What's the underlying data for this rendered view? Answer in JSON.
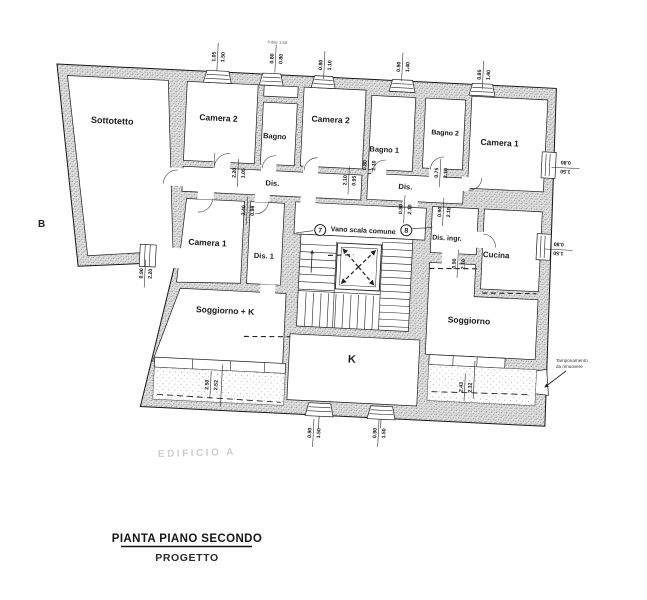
{
  "title": {
    "main": "PIANTA PIANO SECONDO",
    "sub": "PROGETTO"
  },
  "plan": {
    "section_label": "B",
    "watermark": "EDIFICIO A",
    "window_note": "h dav 1.50",
    "stair": {
      "label": "Vano scala comune",
      "unit_left": "7",
      "unit_right": "8"
    },
    "annotation": {
      "line1": "Tamponamento",
      "line2": "da rimuovere"
    },
    "rooms": [
      {
        "id": "sottotetto",
        "label": "Sottotetto",
        "x": 58,
        "y": 57,
        "fs": 9
      },
      {
        "id": "camera2-left",
        "label": "Camera 2",
        "x": 164,
        "y": 49,
        "fs": 8.5
      },
      {
        "id": "bagno",
        "label": "Bagno",
        "x": 221,
        "y": 64,
        "fs": 7.5
      },
      {
        "id": "camera2-right",
        "label": "Camera 2",
        "x": 276,
        "y": 45,
        "fs": 8.5
      },
      {
        "id": "bagno-1",
        "label": "Bagno 1",
        "x": 331,
        "y": 72,
        "fs": 7.5
      },
      {
        "id": "bagno-2",
        "label": "Bagno 2",
        "x": 391,
        "y": 52,
        "fs": 7
      },
      {
        "id": "camera1-right",
        "label": "Camera 1",
        "x": 446,
        "y": 60,
        "fs": 8.5
      },
      {
        "id": "dis-left",
        "label": "Dis.",
        "x": 221,
        "y": 111,
        "fs": 7.5
      },
      {
        "id": "dis-center",
        "label": "Dis.",
        "x": 354,
        "y": 108,
        "fs": 7.5
      },
      {
        "id": "camera1-left",
        "label": "Camera 1",
        "x": 159,
        "y": 174,
        "fs": 8.5
      },
      {
        "id": "dis-1",
        "label": "Dis. 1",
        "x": 216,
        "y": 184,
        "fs": 7.5
      },
      {
        "id": "dis-ingresso",
        "label": "Dis. ingr.",
        "x": 398,
        "y": 157,
        "fs": 7
      },
      {
        "id": "cucina",
        "label": "Cucina",
        "x": 448,
        "y": 172,
        "fs": 8
      },
      {
        "id": "soggiorno-k",
        "label": "Soggiorno + K",
        "x": 180,
        "y": 241,
        "fs": 8.5
      },
      {
        "id": "k",
        "label": "K",
        "x": 309,
        "y": 284,
        "fs": 11
      },
      {
        "id": "soggiorno",
        "label": "Soggiorno",
        "x": 424,
        "y": 239,
        "fs": 8.5
      }
    ],
    "dimensions": [
      {
        "top": "1.05",
        "bottom": "1.50",
        "x": 160,
        "y": -15,
        "rot": -90
      },
      {
        "top": "0.80",
        "bottom": "0.80",
        "x": 218,
        "y": -16,
        "rot": -90
      },
      {
        "top": "0.80",
        "bottom": "1.10",
        "x": 267,
        "y": -12,
        "rot": -90
      },
      {
        "top": "0.90",
        "bottom": "1.40",
        "x": 345,
        "y": -14,
        "rot": -90
      },
      {
        "top": "0.85",
        "bottom": "1.40",
        "x": 426,
        "y": -10,
        "rot": -90
      },
      {
        "top": "1.50",
        "bottom": "0.80",
        "x": 513,
        "y": 79,
        "rot": 180
      },
      {
        "top": "1.50",
        "bottom": "0.80",
        "x": 510,
        "y": 161,
        "rot": 180
      },
      {
        "top": "2.20",
        "bottom": "1.05",
        "x": 186,
        "y": 100,
        "rot": -90
      },
      {
        "top": "2.40",
        "bottom": "0.98",
        "x": 197,
        "y": 137,
        "rot": -90
      },
      {
        "top": "2.10",
        "bottom": "0.95",
        "x": 297,
        "y": 102,
        "rot": -90
      },
      {
        "top": "0.80",
        "bottom": "2.10",
        "x": 316,
        "y": 86,
        "rot": -90
      },
      {
        "top": "0.75",
        "bottom": "2.10",
        "x": 388,
        "y": 90,
        "rot": -90
      },
      {
        "top": "0.80",
        "bottom": "2.10",
        "x": 354,
        "y": 128,
        "rot": -90
      },
      {
        "top": "0.90",
        "bottom": "2.10",
        "x": 393,
        "y": 129,
        "rot": -90
      },
      {
        "top": "0.90",
        "bottom": "2.10",
        "x": 410,
        "y": 180,
        "rot": -90
      },
      {
        "top": "0.90",
        "bottom": "2.20",
        "x": 98,
        "y": 205,
        "rot": -90
      },
      {
        "top": "0.90",
        "bottom": "1.50",
        "x": 274,
        "y": 356,
        "rot": -90
      },
      {
        "top": "0.90",
        "bottom": "1.50",
        "x": 339,
        "y": 353,
        "rot": -90
      },
      {
        "top": "2.50",
        "bottom": "2.52",
        "x": 169,
        "y": 313,
        "rot": -90
      },
      {
        "top": "2.43",
        "bottom": "2.32",
        "x": 423,
        "y": 303,
        "rot": -90
      }
    ]
  }
}
